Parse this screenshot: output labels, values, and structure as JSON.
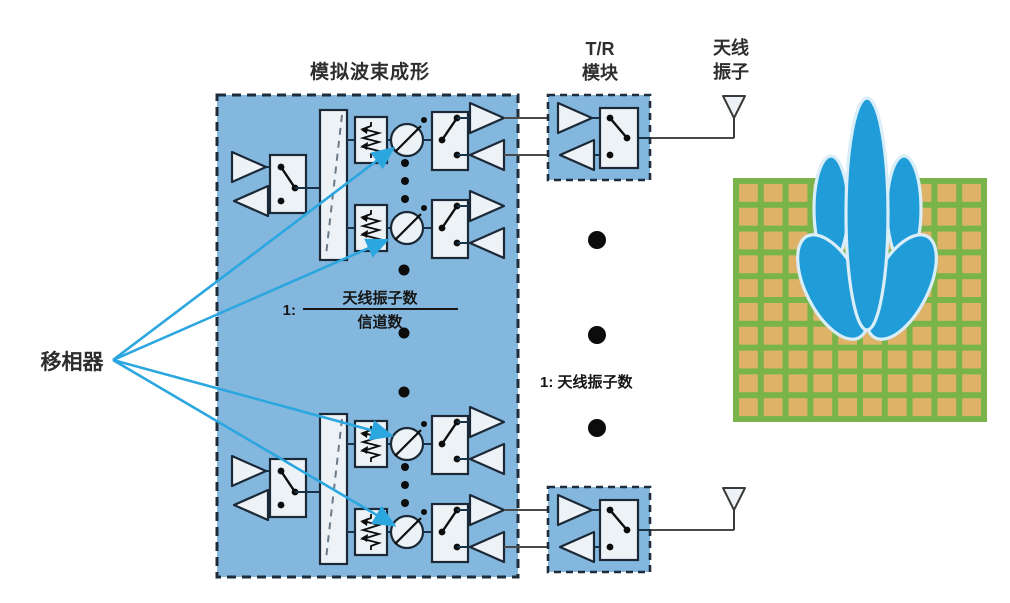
{
  "diagram": {
    "title_labels": {
      "analog_beamforming": "模拟波束成形",
      "tr_module": [
        "T/R",
        "模块"
      ],
      "antenna_element": [
        "天线",
        "振子"
      ]
    },
    "annotations": {
      "phase_shifter": "移相器",
      "channel_ratio": {
        "prefix": "1:",
        "numerator": "天线振子数",
        "denominator": "信道数"
      },
      "element_ratio": "1: 天线振子数"
    },
    "components": [
      "transmit-amplifier-icon",
      "receive-amplifier-icon",
      "spdt-switch-icon",
      "power-splitter-icon",
      "variable-attenuator-icon",
      "phase-shifter-icon",
      "tr-module",
      "antenna-element-icon",
      "antenna-array-panel",
      "beam-pattern"
    ],
    "colors": {
      "module_fill": "#84b7de",
      "component_fill": "#edf2f7",
      "outline": "#1b2836",
      "wire": "#16334a",
      "pointer_blue": "#2ba6df",
      "beam_blue": "#209cd8",
      "beam_outline": "#d9eef9",
      "grid_green": "#79b44b",
      "grid_cell": "#dfb367",
      "text": "#2e2e2e"
    }
  }
}
